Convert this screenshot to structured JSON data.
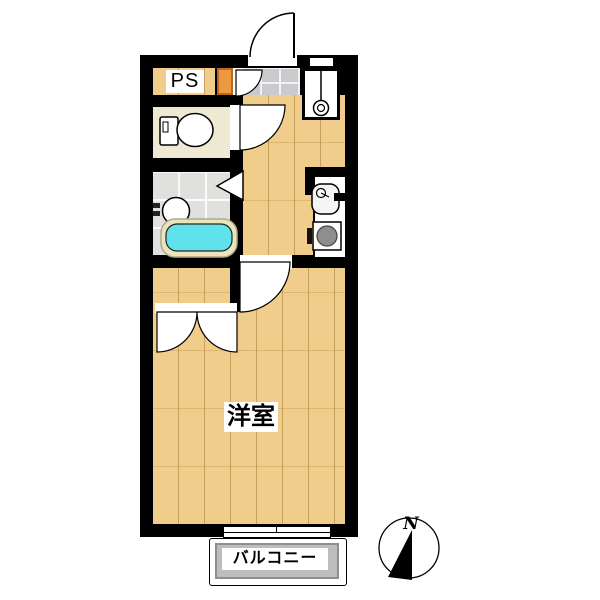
{
  "plan": {
    "type": "apartment-floor-plan",
    "labels": {
      "pipe_space": "PS",
      "closet": "クローゼット",
      "western_room": "洋室",
      "balcony": "バルコニー",
      "compass_north": "N"
    },
    "rooms": [
      {
        "name": "western_room",
        "label": "洋室",
        "floor": "wood"
      },
      {
        "name": "hall_kitchen",
        "label": "",
        "floor": "wood"
      },
      {
        "name": "toilet_room",
        "label": "",
        "floor": "cream"
      },
      {
        "name": "bathroom",
        "label": "",
        "floor": "gray-tile"
      },
      {
        "name": "genkan_entrance",
        "label": "",
        "floor": "stone-tile"
      },
      {
        "name": "closet",
        "label": "クローゼット",
        "floor": "orange"
      },
      {
        "name": "balcony",
        "label": "バルコニー",
        "floor": "concrete"
      }
    ],
    "fixtures": [
      "toilet",
      "bathtub",
      "wash-basin",
      "kitchen-sink",
      "gas-stove",
      "washing-machine-pan",
      "entrance-door",
      "room-door",
      "toilet-door",
      "closet-double-door",
      "bath-folding-door",
      "sliding-window",
      "compass"
    ],
    "colors": {
      "wall": "#000000",
      "wood_floor": "#f0cd8a",
      "plank_line": "#a67c37",
      "closet_orange": "#f09140",
      "shoe_box_orange": "#ef9840",
      "bathtub_cyan": "#5fe2ec",
      "tub_rim_cream": "#ece4bc",
      "genkan_tile_gray": "#c9c9ce",
      "bath_tile_gray": "#e0e0de",
      "toilet_floor_cream": "#eee9d2",
      "balcony_gray": "#bdbdbd",
      "stove_burner_gray": "#8e8e8e"
    }
  }
}
